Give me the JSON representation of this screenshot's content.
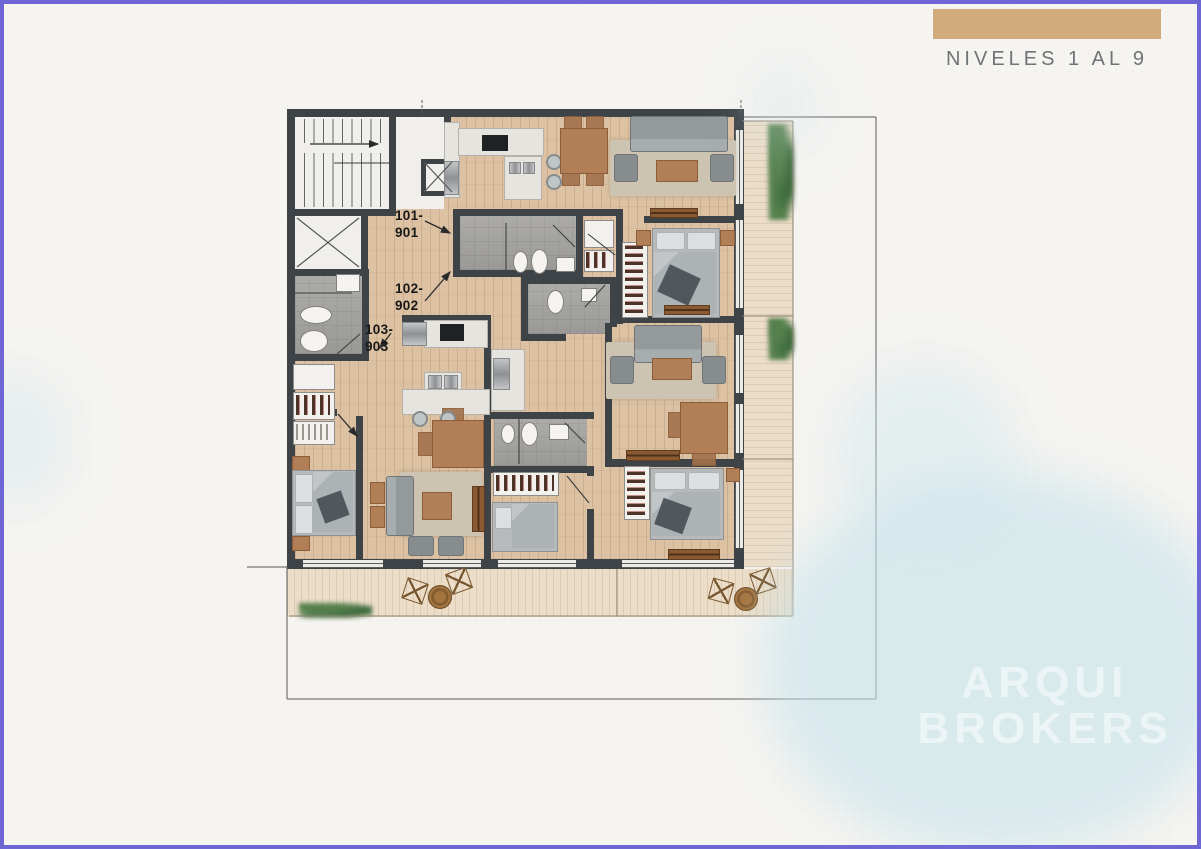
{
  "page": {
    "background_color": "#f5f4f1",
    "border_color": "#6f66d6"
  },
  "title_block": {
    "swatch_color": "#d2ab7d",
    "title": "NIVELES 1 AL 9"
  },
  "watermark": {
    "line1": "ARQUI",
    "line2": "BROKERS"
  },
  "plan": {
    "units": [
      {
        "id": "101-901",
        "label_line1": "101-",
        "label_line2": "901"
      },
      {
        "id": "102-902",
        "label_line1": "102-",
        "label_line2": "902"
      },
      {
        "id": "103-903",
        "label_line1": "103-",
        "label_line2": "903"
      }
    ],
    "colors": {
      "wall": "#3e4347",
      "wood_floor": "#dcc1a3",
      "deck": "#ecddc8",
      "bathroom_tile": "#a6a5a1",
      "kitchen_counter": "#e6e4df",
      "rug": "#cdc3b1",
      "upholstery": "#949a9c",
      "wood_furniture": "#b27e55",
      "plants": "#4d7748",
      "stair_core": "#f0efeb"
    }
  }
}
